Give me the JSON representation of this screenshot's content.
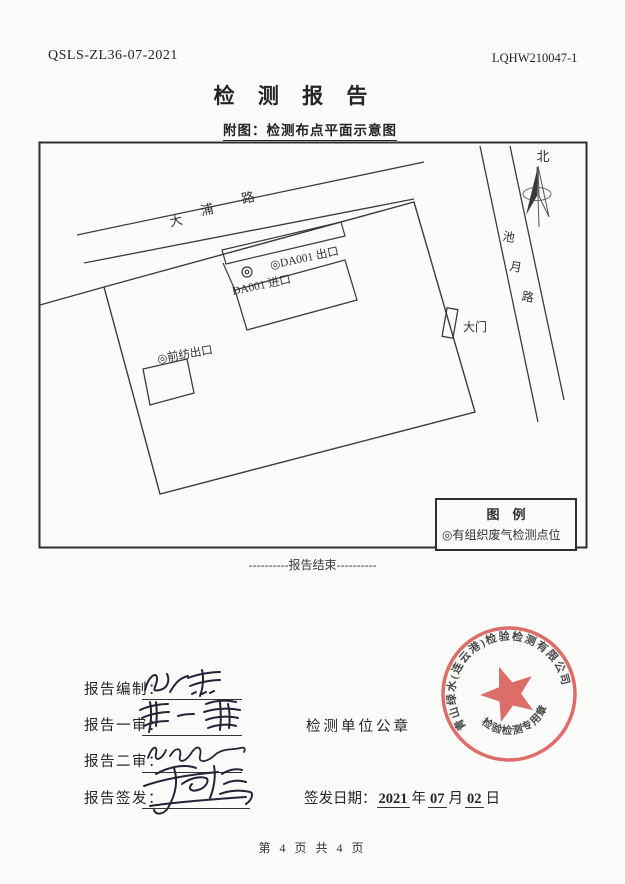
{
  "header": {
    "code_left": "QSLS-ZL36-07-2021",
    "code_right": "LQHW210047-1"
  },
  "title": "检 测 报 告",
  "figure_caption": "附图：检测布点平面示意图",
  "diagram": {
    "north_label": "北",
    "road_dapu": {
      "char1": "大",
      "char2": "浦",
      "char3": "路"
    },
    "road_chiyue": {
      "char1": "池",
      "char2": "月",
      "char3": "路"
    },
    "label_da001_outlet": "◎DA001 出口",
    "label_da001_inlet": "DA001 进口",
    "label_qianfang": "◎前纺出口",
    "label_gate": "大门",
    "legend": {
      "title": "图　例",
      "item": "◎有组织废气检测点位"
    }
  },
  "end_marker": "----------报告结束----------",
  "signoff": {
    "row1_label": "报告编制：",
    "row2_label": "报告一审：",
    "row3_label": "报告二审：",
    "row4_label": "报告签发：",
    "seal_caption": "检测单位公章",
    "date_label": "签发日期：",
    "date_year": "2021",
    "date_year_unit": "年",
    "date_month": "07",
    "date_month_unit": "月",
    "date_day": "02",
    "date_day_unit": "日",
    "stamp": {
      "arc_text": "青山绿水(连云港)检验检测有限公司",
      "bottom_text": "检验检测专用章",
      "color": "#d85a55"
    }
  },
  "footer": "第 4 页 共 4 页"
}
